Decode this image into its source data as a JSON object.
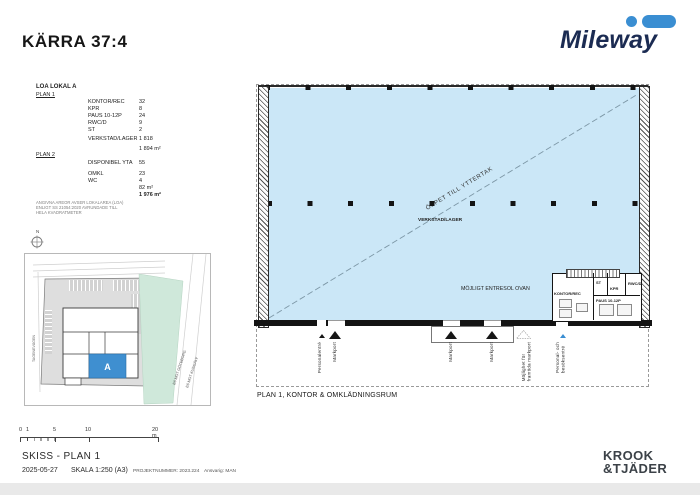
{
  "page": {
    "title": "KÄRRA 37:4"
  },
  "brand": {
    "name": "Mileway",
    "accent_blue": "#3a8ed2",
    "navy": "#1b2b52"
  },
  "area_table": {
    "heading": "LOA LOKAL A",
    "plan1_label": "PLAN 1",
    "plan1_rows": [
      {
        "label": "KONTOR/REC",
        "value": "32"
      },
      {
        "label": "KPR",
        "value": "8"
      },
      {
        "label": "PAUS 10-12P",
        "value": "24"
      },
      {
        "label": "RWC/D",
        "value": "9"
      },
      {
        "label": "ST",
        "value": "2"
      }
    ],
    "plan1_big_row": {
      "label": "VERKSTAD/LAGER",
      "value": "1 818"
    },
    "plan1_subtotal": "1 894 m²",
    "plan2_label": "PLAN 2",
    "plan2_rows": [
      {
        "label": "DISPONIBEL YTA",
        "value": "55"
      },
      {
        "label": "OMKL",
        "value": "23"
      },
      {
        "label": "WC",
        "value": "4"
      }
    ],
    "plan2_subtotal": "82 m²",
    "total": "1 976 m²",
    "note_line1": "ANGIVNA AREOR AVSER LOKALAREA (LOA)",
    "note_line2": "ENLIGT SS 21054:2020 AVRUNDADE TILL",
    "note_line3": "HELA KVADRATMETER"
  },
  "site_plan": {
    "compass_label": "N",
    "building_label": "A",
    "road_left": "TAGENEVÄGEN",
    "road_right_1": "E6 MOT GÖTEBORG",
    "road_right_2": "E6 MOT KUNGÄLV",
    "building_fill": "#3f8fd0",
    "green_fill": "#cfe8da",
    "parcel_fill": "#dedede"
  },
  "floor_plan": {
    "diagonal_label": "ÖPPET TILL YTTERTAK",
    "hall_label": "VERKSTAD/LAGER",
    "entresol_label": "MÖJLIGT ENTRESOL OVAN",
    "room_kontor": "KONTOR/REC",
    "room_st": "ST",
    "room_kpr": "KPR",
    "room_rwc": "RWC/D",
    "room_paus": "PAUS 10-12P",
    "entrance_personal": "Personalentré",
    "entrance_markport1": "Markport",
    "entrance_markport2": "Markport",
    "entrance_markport3": "Markport",
    "entrance_future_line1": "Möjlighet för",
    "entrance_future_line2": "framtida markport",
    "entrance_visitor_line1": "Personal- och",
    "entrance_visitor_line2": "besöksentré",
    "caption": "PLAN 1, KONTOR & OMKLÄDNINGSRUM",
    "fill": "#cbe7f7"
  },
  "title_block": {
    "scale_0": "0",
    "scale_1": "1",
    "scale_5": "5",
    "scale_10": "10",
    "scale_20": "20 m",
    "drawing_title": "SKISS - PLAN 1",
    "date": "2025-05-27",
    "scale_text": "SKALA 1:250 (A3)",
    "project_number": "PROJEKTNUMMER: 2023.224",
    "responsible": "Ansvarig: MAN"
  },
  "architect": {
    "line1": "KROOK",
    "line2": "&TJÄDER"
  }
}
